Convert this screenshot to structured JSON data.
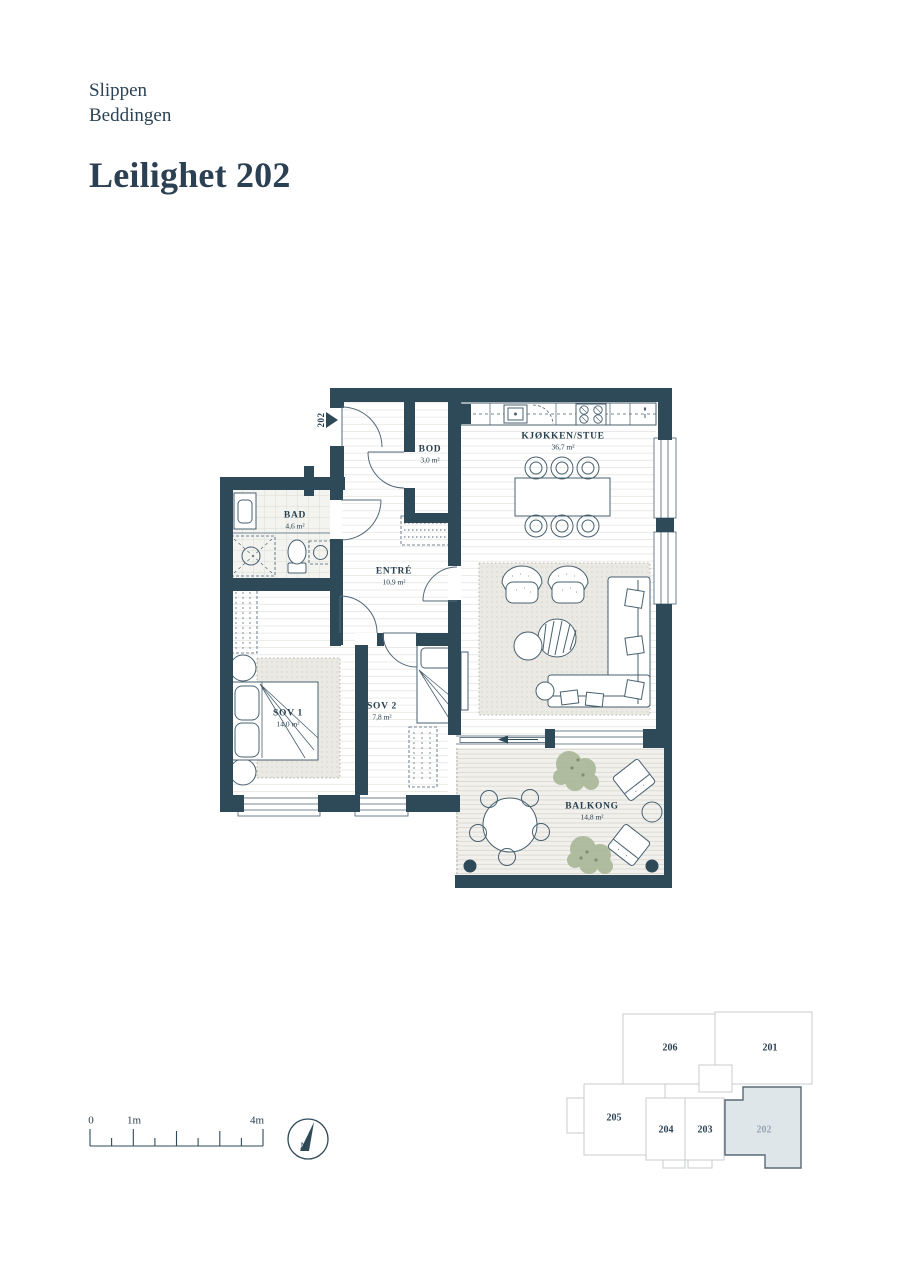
{
  "header": {
    "project": "Slippen",
    "building": "Beddingen",
    "title": "Leilighet 202"
  },
  "plan": {
    "entrance_label": "202",
    "rooms": [
      {
        "name": "BOD",
        "area": "3,0 m²"
      },
      {
        "name": "KJØKKEN/STUE",
        "area": "36,7 m²"
      },
      {
        "name": "BAD",
        "area": "4,6 m²"
      },
      {
        "name": "ENTRÉ",
        "area": "10,9 m²"
      },
      {
        "name": "SOV 1",
        "area": "14,0 m²"
      },
      {
        "name": "SOV 2",
        "area": "7,8 m²"
      },
      {
        "name": "BALKONG",
        "area": "14,8 m²"
      }
    ]
  },
  "scale_bar": {
    "labels": [
      "0",
      "1m",
      "4m"
    ]
  },
  "compass": {
    "label": "N"
  },
  "minimap": {
    "units": [
      "206",
      "201",
      "205",
      "204",
      "203",
      "202"
    ],
    "highlighted_unit": "202"
  },
  "colors": {
    "wall": "#2e4a58",
    "ink": "#28404f",
    "highlight_fill": "#dfe6ea"
  }
}
